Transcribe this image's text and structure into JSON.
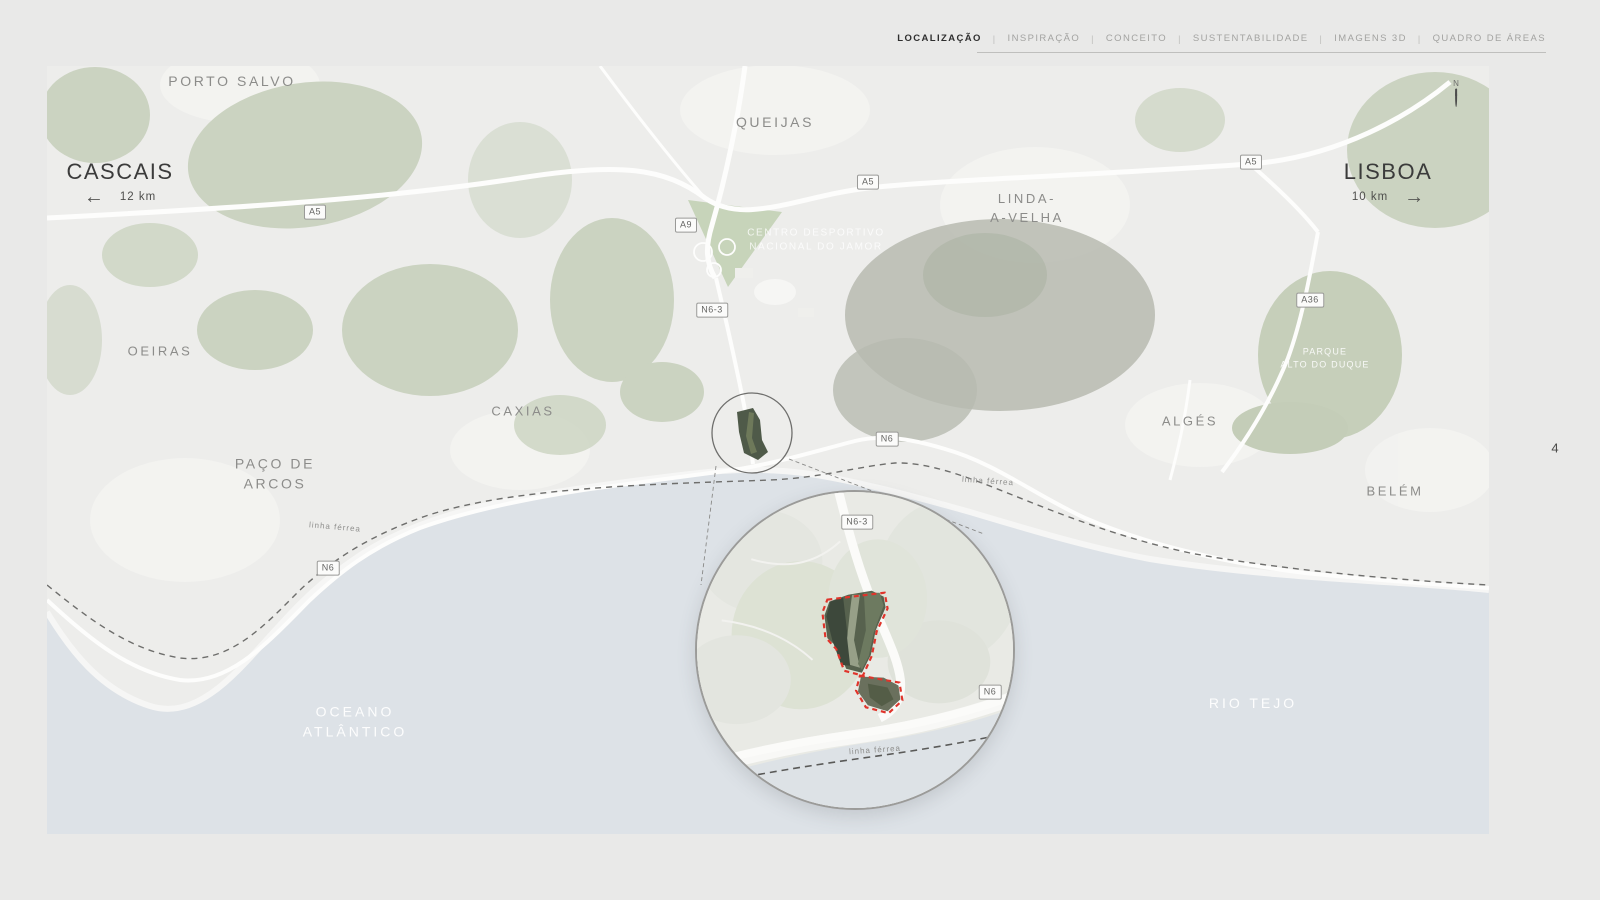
{
  "nav": {
    "separator": "|",
    "active": "LOCALIZAÇÃO",
    "items": [
      {
        "label": "LOCALIZAÇÃO"
      },
      {
        "label": "INSPIRAÇÃO"
      },
      {
        "label": "CONCEITO"
      },
      {
        "label": "SUSTENTABILIDADE"
      },
      {
        "label": "IMAGENS 3D"
      },
      {
        "label": "QUADRO DE ÁREAS"
      }
    ]
  },
  "page_number": "4",
  "map": {
    "cascais": {
      "name": "CASCAIS",
      "distance": "12 km",
      "arrow": "←"
    },
    "lisboa": {
      "name": "LISBOA",
      "distance": "10 km",
      "arrow": "→"
    },
    "north_label": "N",
    "railway_label_left": "linha férrea",
    "railway_label_right": "linha férrea",
    "places": {
      "porto_salvo": "PORTO SALVO",
      "queijas": "QUEIJAS",
      "linda_a_velha": "LINDA-\nA-VELHA",
      "jamor": "CENTRO DESPORTIVO\nNACIONAL DO JAMOR",
      "oeiras": "OEIRAS",
      "caxias": "CAXIAS",
      "paco_de_arcos": "PAÇO DE\nARCOS",
      "alges": "ALGÉS",
      "parque_alto_do_duque": "PARQUE\nALTO DO DUQUE",
      "belem": "BELÉM",
      "oceano_atlantico": "OCEANO\nATLÂNTICO",
      "rio_tejo": "RIO TEJO"
    },
    "road_badges": {
      "a5_left": "A5",
      "a9": "A9",
      "a5_mid": "A5",
      "a5_right": "A5",
      "a36": "A36",
      "n6_3": "N6-3",
      "n6_mid": "N6",
      "n6_left": "N6"
    }
  },
  "inset": {
    "badge_n6_3": "N6-3",
    "badge_n6": "N6",
    "railway_label": "linha férrea"
  },
  "colors": {
    "site_outline": "#e0342b",
    "water": "#dde2e7",
    "green": "#cbd3c1",
    "accent_active": "#2f2f2f"
  }
}
